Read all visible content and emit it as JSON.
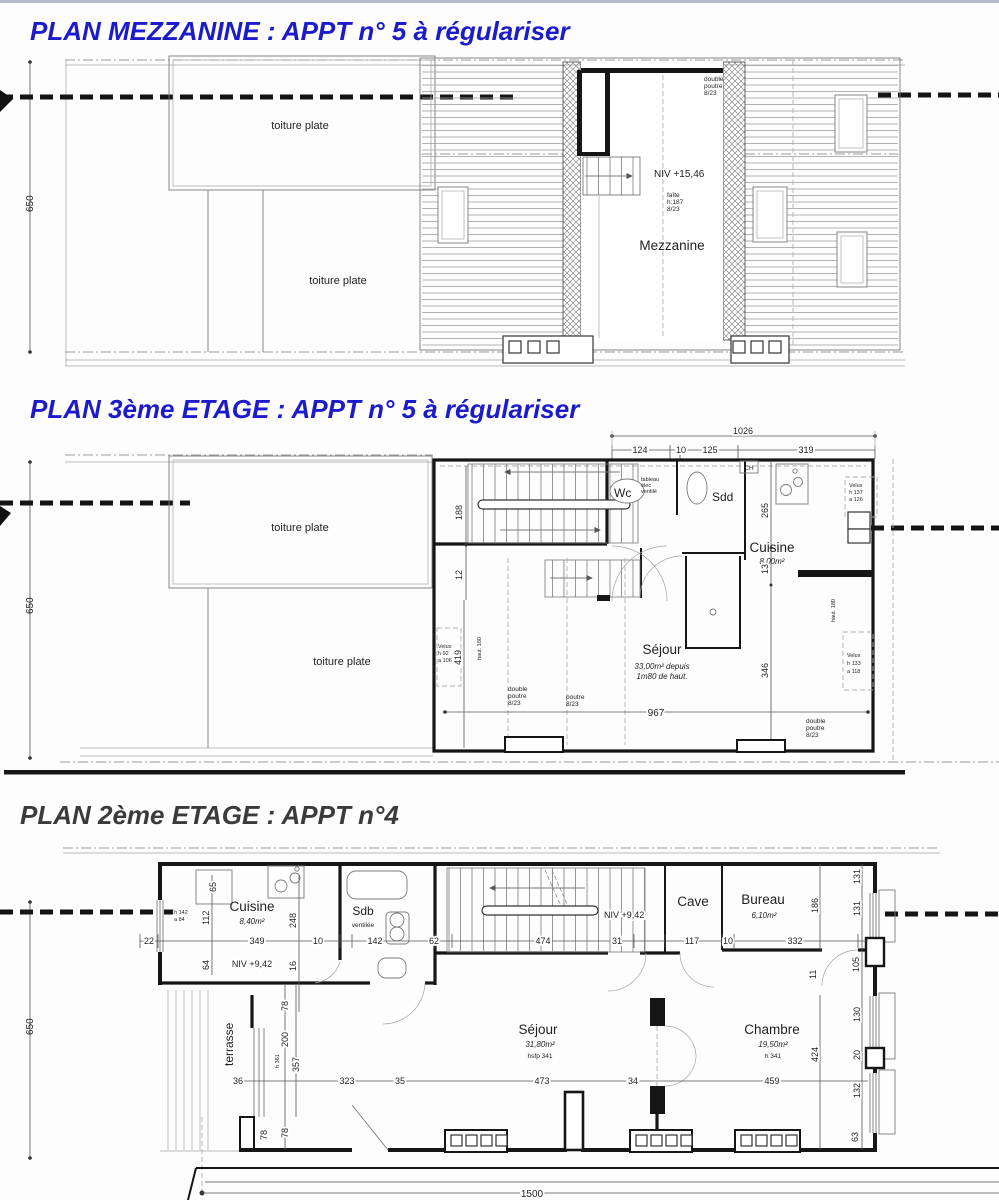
{
  "colors": {
    "title_blue": "#1b1bcb",
    "title_dark": "#3b3b3b",
    "wall_line": "#161616",
    "background": "#fdfdfd"
  },
  "plans": [
    {
      "title": "PLAN MEZZANINE : APPT n° 5 à régulariser",
      "t": {
        "dim650": "650",
        "toiture_a": "toiture plate",
        "toiture_b": "toiture plate",
        "niv": "NIV +15,46",
        "faite1": "faîte",
        "faite2": "h:187",
        "faite3": "8/23",
        "mezz": "Mezzanine",
        "poutre1": "double",
        "poutre2": "poutre",
        "poutre3": "8/23"
      }
    },
    {
      "title": "PLAN 3ème ETAGE : APPT n° 5 à régulariser",
      "t": {
        "d1026": "1026",
        "d124": "124",
        "d10": "10",
        "d125": "125",
        "d319": "319",
        "dim650": "650",
        "toiture_a": "toiture plate",
        "toiture_b": "toiture plate",
        "d188": "188",
        "d12": "12",
        "d419": "419",
        "vl1": "Velux",
        "vl2": "h 92",
        "vl3": "a 106",
        "haut_l": "haut. 180",
        "wc": "Wc",
        "tab1": "tableau",
        "tab2": "élec",
        "tab3": "ventilé",
        "sdd": "Sdd",
        "ch": "CH",
        "cuisine": "Cuisine",
        "cuisine_m2": "8,00m²",
        "d265": "265",
        "d13": "13",
        "d346": "346",
        "vt1": "Velux",
        "vt2": "h 137",
        "vt3": "a 126",
        "sejour": "Séjour",
        "sejour_m2a": "33,00m² depuis",
        "sejour_m2b": "1m80 de haut.",
        "dp1": "double",
        "dp2": "poutre",
        "dp3": "8/23",
        "p1": "poutre",
        "p2": "8/23",
        "d967": "967",
        "haut_r": "haut. 180",
        "vr1": "Velux",
        "vr2": "h 133",
        "vr3": "a 118",
        "dp21": "double",
        "dp22": "poutre",
        "dp23": "8/23"
      }
    },
    {
      "title": "PLAN 2ème ETAGE : APPT n°4",
      "t": {
        "dim650": "650",
        "d65": "65",
        "wn1": "h 142",
        "wn2": "a 84",
        "cuisine": "Cuisine",
        "cuisine_m2": "8,40m²",
        "niv1": "NIV +9,42",
        "d112": "112",
        "d64": "64",
        "d248": "248",
        "d16": "16",
        "d22": "22",
        "d349": "349",
        "d10a": "10",
        "d142": "142",
        "d62": "62",
        "d474": "474",
        "d31": "31",
        "d117": "117",
        "d10b": "10",
        "d332": "332",
        "sdb": "Sdb",
        "vent": "ventilée",
        "niv2": "NIV +9,42",
        "cave": "Cave",
        "bureau": "Bureau",
        "bureau_m2": "6,10m²",
        "d186": "186",
        "d131a": "131",
        "d131b": "131",
        "d105": "105",
        "d130": "130",
        "d20": "20",
        "d132": "132",
        "d63": "63",
        "d11": "11",
        "d424": "424",
        "terrasse": "terrasse",
        "d78a": "78",
        "d200": "200",
        "d357": "357",
        "h361": "h 361",
        "d78b": "78",
        "d78c": "78",
        "d36": "36",
        "d323": "323",
        "d35": "35",
        "d473": "473",
        "d34": "34",
        "d459": "459",
        "sejour": "Séjour",
        "sejour_m2": "31,80m²",
        "sejour_h": "hsfp 341",
        "chambre": "Chambre",
        "chambre_m2": "19,50m²",
        "chambre_h": "h 341",
        "d1500": "1500"
      }
    }
  ]
}
